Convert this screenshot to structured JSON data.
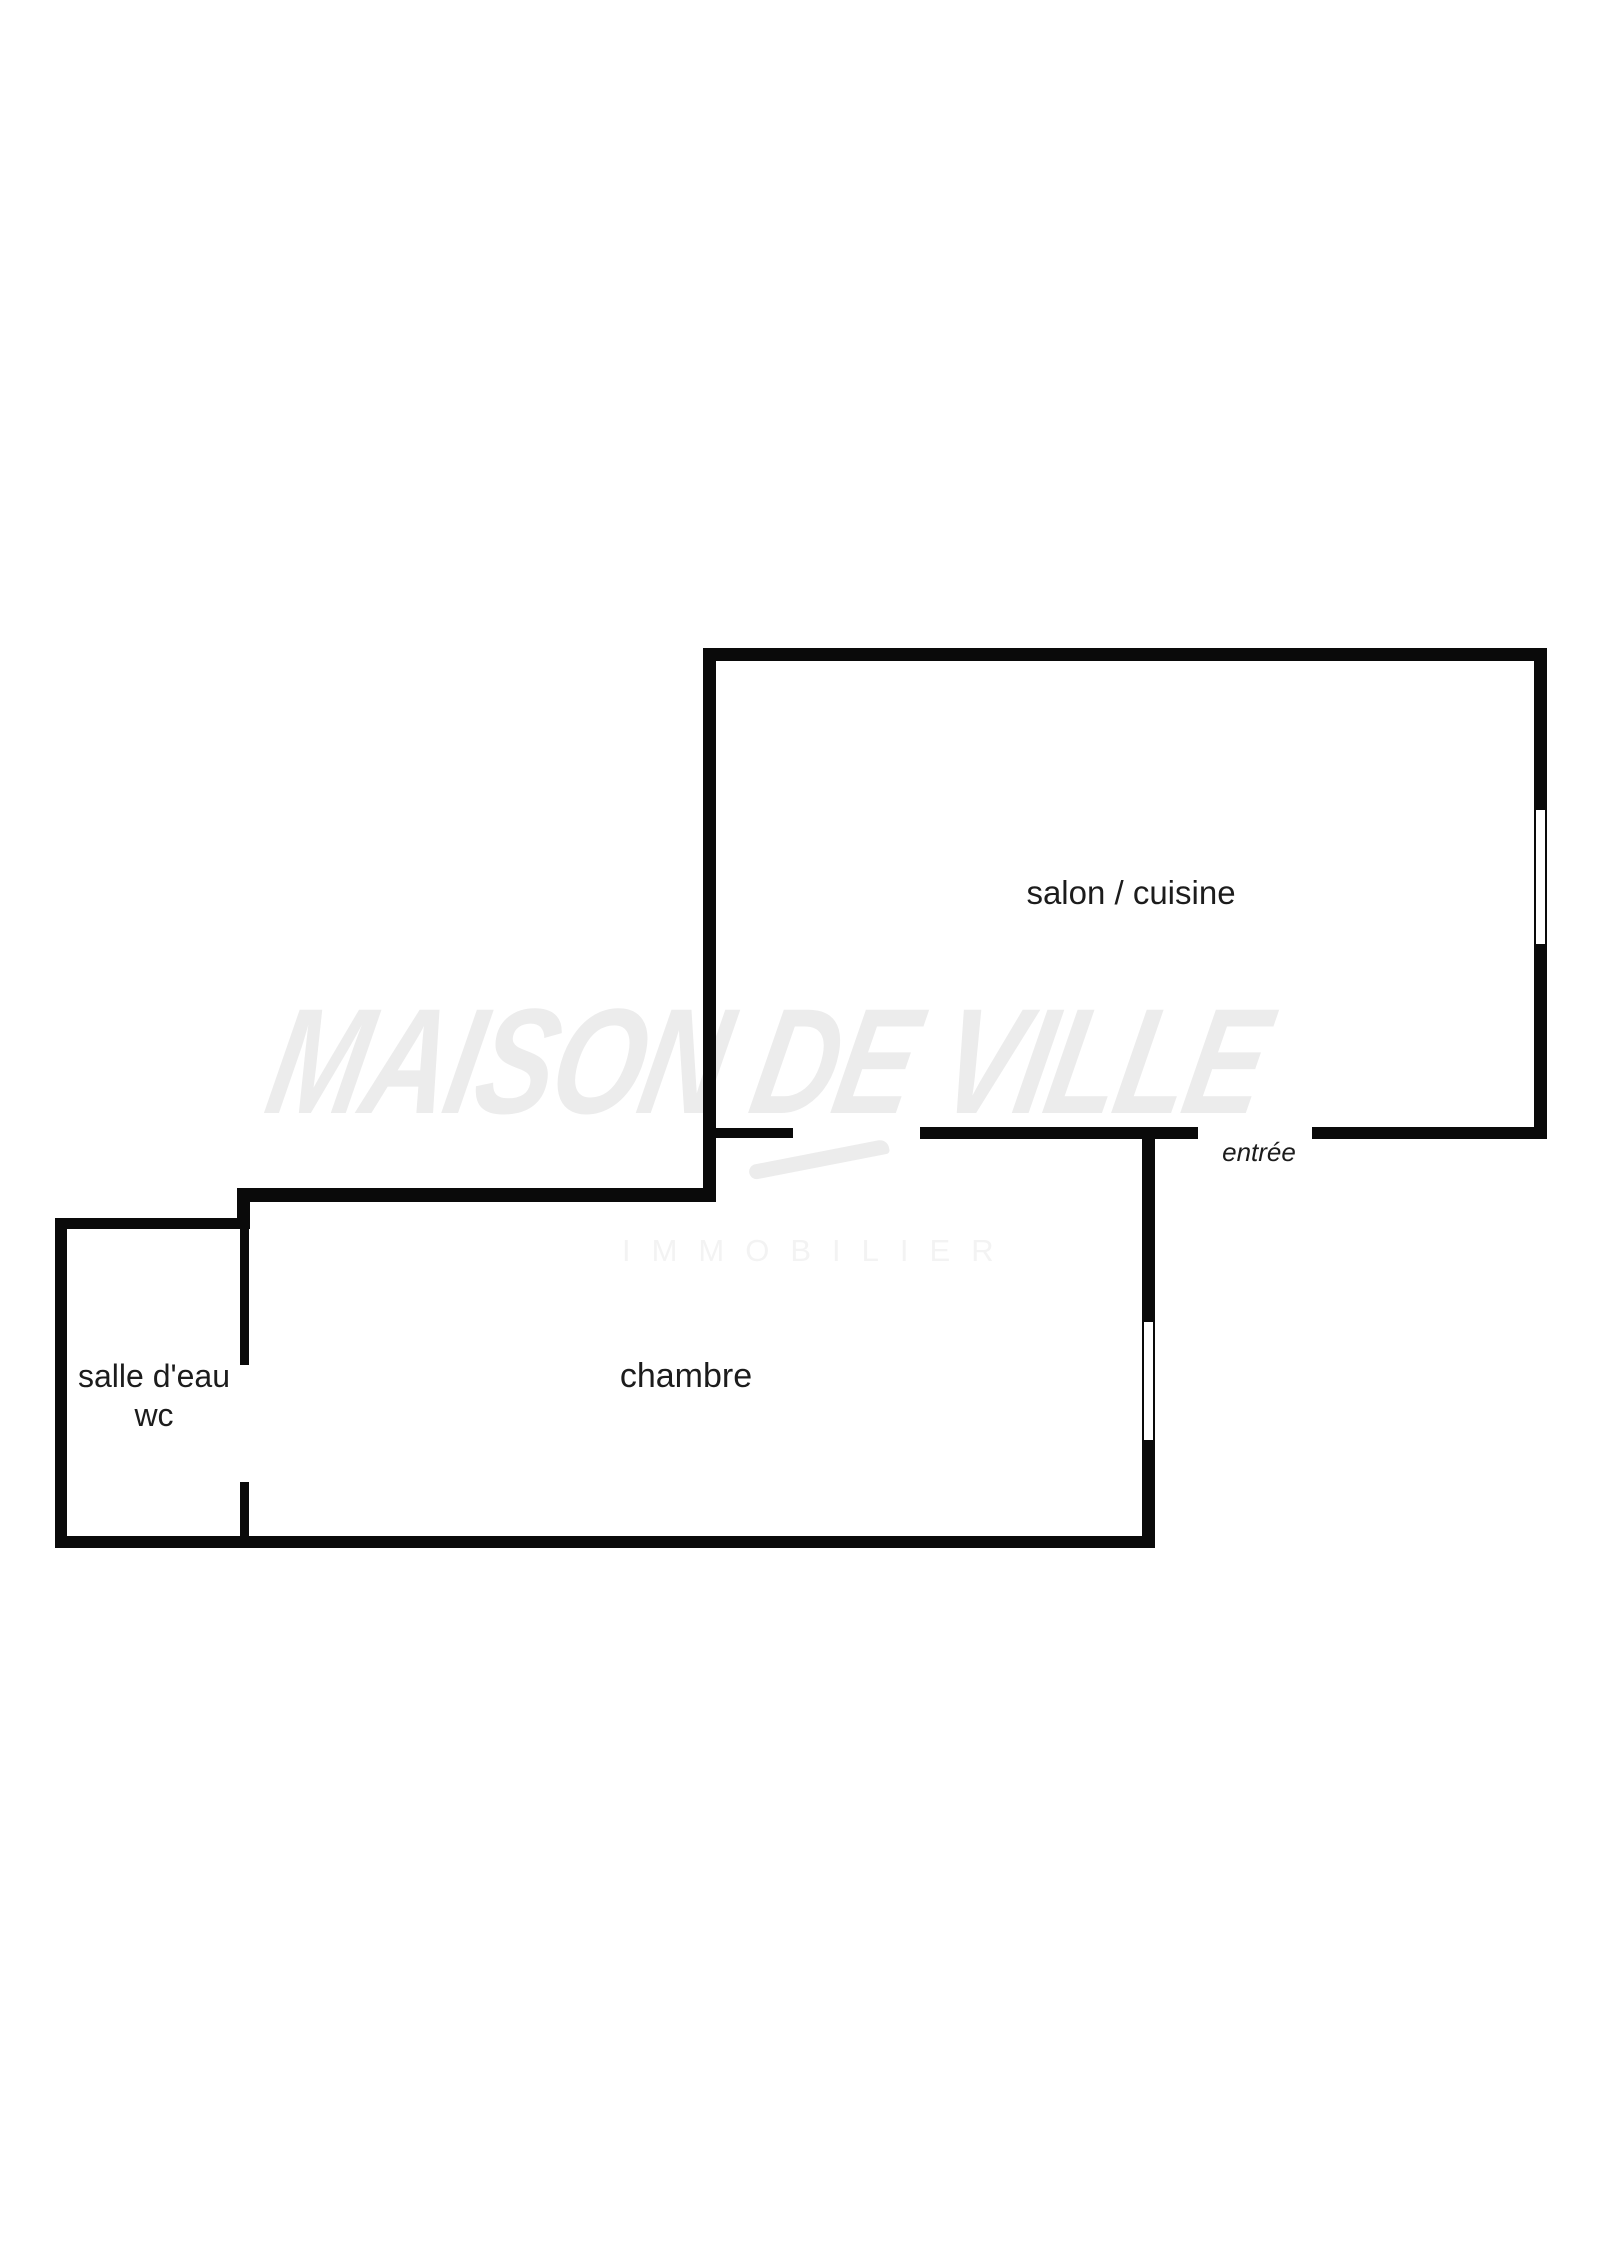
{
  "floorplan": {
    "labels": {
      "salon": "salon / cuisine",
      "entree": "entrée",
      "chambre": "chambre",
      "salle_eau_line1": "salle d'eau",
      "salle_eau_line2": "wc"
    },
    "watermark": {
      "title": "MAISON DE VILLE",
      "subtitle": "IMMOBILIER"
    },
    "colors": {
      "wall": "#0a0a0a",
      "label_text": "#1c1c1c",
      "watermark_title": "#ececec",
      "watermark_subtitle": "#f3f3f3",
      "background": "#ffffff"
    }
  }
}
